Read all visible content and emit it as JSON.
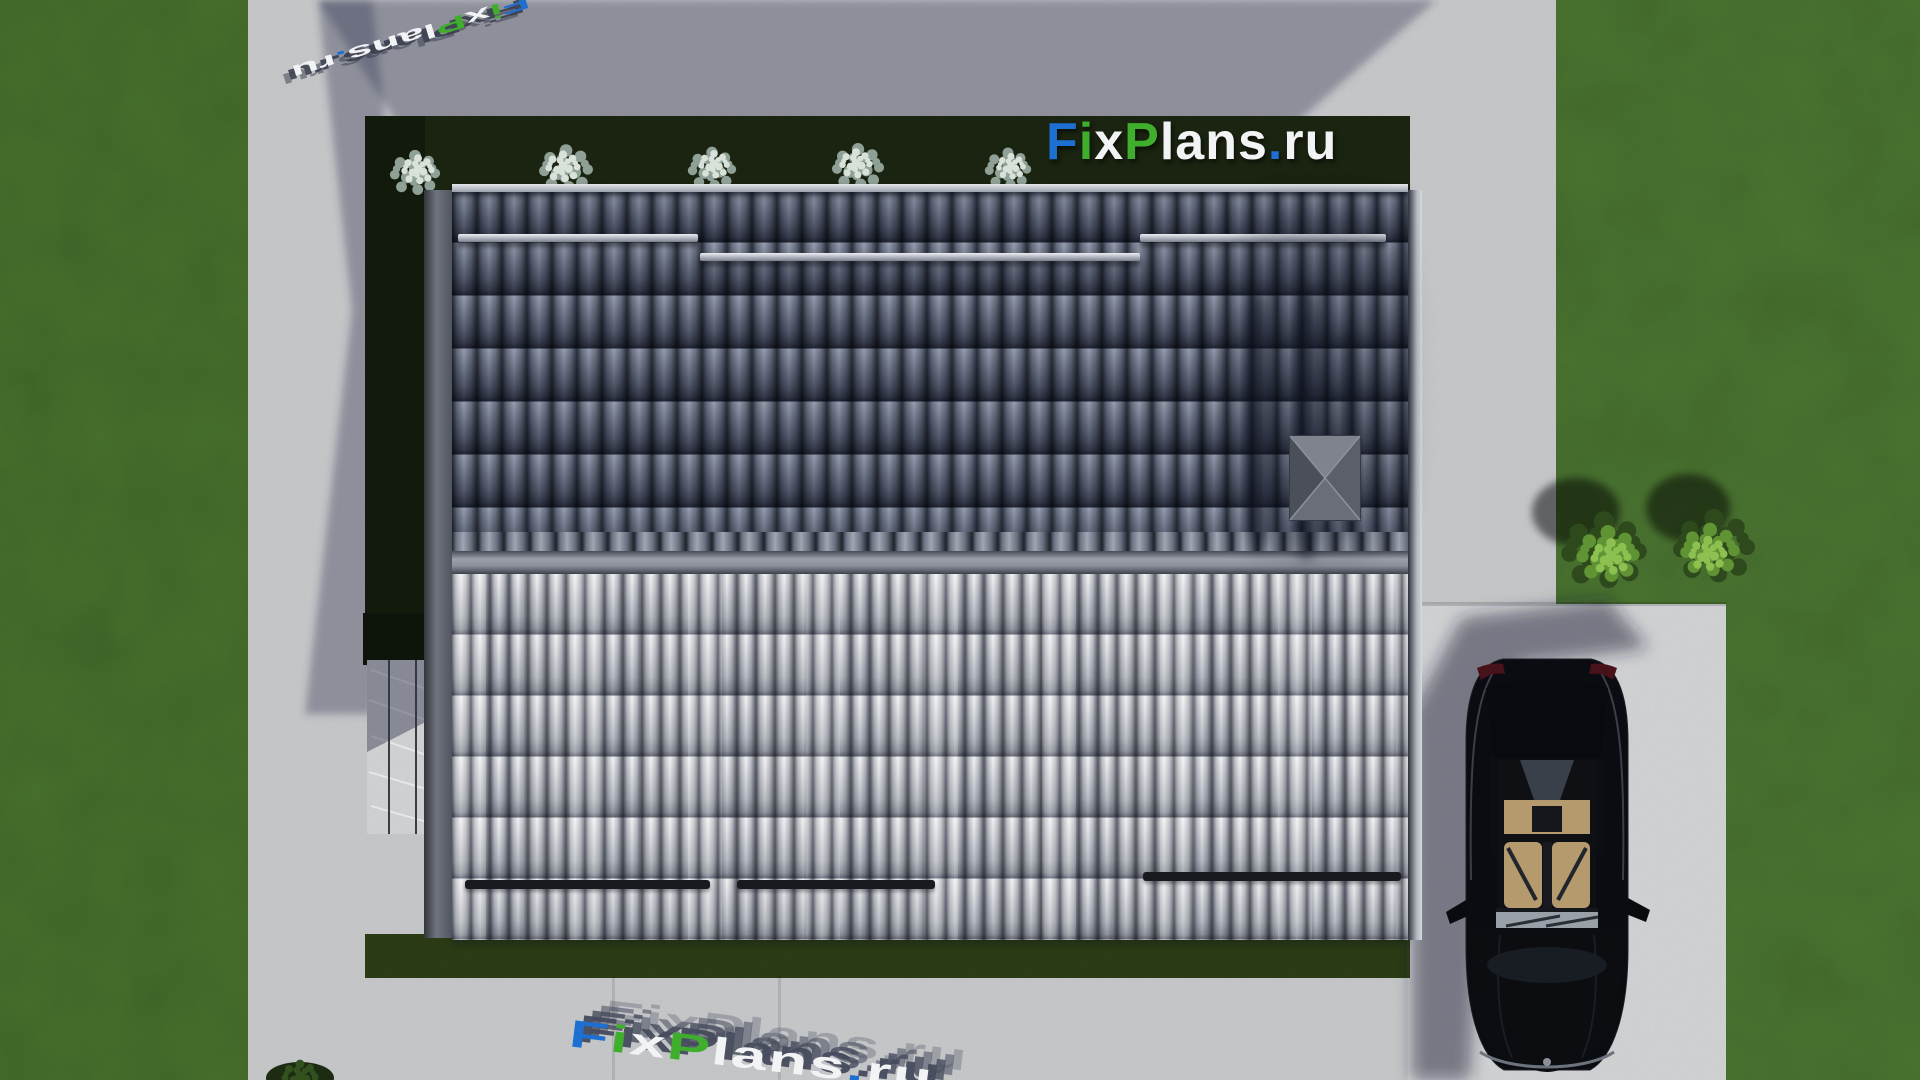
{
  "watermark": {
    "text": "FixPlans.ru",
    "segments": [
      {
        "t": "F",
        "c": "#1e6fd2"
      },
      {
        "t": "i",
        "c": "#3fae2c"
      },
      {
        "t": "x",
        "c": "#f2f3f5"
      },
      {
        "t": "P",
        "c": "#3fae2c"
      },
      {
        "t": "l",
        "c": "#f2f3f5"
      },
      {
        "t": "a",
        "c": "#f2f3f5"
      },
      {
        "t": "n",
        "c": "#f2f3f5"
      },
      {
        "t": "s",
        "c": "#f2f3f5"
      },
      {
        "t": ".",
        "c": "#1e6fd2"
      },
      {
        "t": "r",
        "c": "#f2f3f5"
      },
      {
        "t": "u",
        "c": "#f2f3f5"
      }
    ]
  },
  "scene": {
    "colors": {
      "grass": "#47702c",
      "grass_right": "#4a7530",
      "hedge": "#1a2410",
      "hedge_shade": "#121a0c",
      "hedge_bottom": "#2b3c15",
      "concrete": "#c7c9cb",
      "concrete_sunlit": "#d2d4d6",
      "patio": "#d3d4d6",
      "roof_dark": "#9aa0ac",
      "roof_light": "#e8e9eb",
      "ridge": "#8b8f99",
      "car_body": "#0a0c11",
      "car_interior": "#b59a6e",
      "logo_blue": "#1e6fd2",
      "logo_green": "#3fae2c",
      "logo_white": "#f2f3f5"
    }
  }
}
